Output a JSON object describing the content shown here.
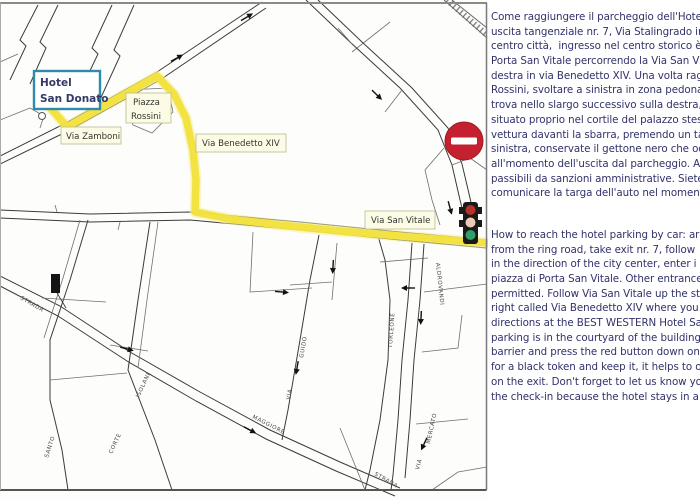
{
  "map": {
    "hotel_label": {
      "line1": "Hotel",
      "line2": "San Donato"
    },
    "boxed_labels": {
      "piazza_rossini_1": "Piazza",
      "piazza_rossini_2": "Rossini",
      "via_zamboni": "Via Zamboni",
      "via_benedetto_xiv": "Via Benedetto XIV",
      "via_san_vitale": "Via San Vitale"
    },
    "street_labels": [
      {
        "text": "STRADA"
      },
      {
        "text": "MAGGIORE"
      },
      {
        "text": "STRADA"
      },
      {
        "text": "SANTO"
      },
      {
        "text": "CORTE"
      },
      {
        "text": "ISOLANI"
      },
      {
        "text": "GUIDO"
      },
      {
        "text": "VIA"
      },
      {
        "text": "TORLEONE"
      },
      {
        "text": "ALDROVANDI"
      },
      {
        "text": "MERCATO"
      },
      {
        "text": "VIA"
      }
    ],
    "icons": {
      "no_entry": "no-entry-sign",
      "traffic_light": "traffic-light",
      "hotel_marker": "hotel-location-dot",
      "building": "building-marker"
    },
    "colors": {
      "route_yellow": "#f2e13b",
      "route_glow": "#f7ef9a",
      "hotel_box_border": "#2e8bac",
      "no_entry_red": "#c5202f",
      "traffic_red": "#b5332b",
      "traffic_mid": "#e9cbb8",
      "traffic_green": "#2fa06a",
      "street_line": "#3b3b3b",
      "label_box_bg": "#fcfce6",
      "text_navy": "#32326b"
    }
  },
  "directions": {
    "italian": {
      "lines": [
        "Come raggiungere il parcheggio dell'Hotel",
        "uscita tangenziale nr. 7, Via Stalingrado in",
        "centro città,  ingresso nel centro storico è",
        "Porta San Vitale percorrendo la Via San Vit",
        "destra in via Benedetto XIV. Una volta rag",
        "Rossini, svoltare a sinistra in zona pedona",
        "trova nello slargo successivo sulla destra,",
        "situato proprio nel cortile del palazzo stes",
        "vettura davanti la sbarra, premendo un ta",
        "sinistra, conservate il gettone nero che oc",
        "all'momento dell'uscita dal parcheggio. Alt",
        "passibili da sanzioni amministrative. Siete",
        "comunicare la targa dell'auto nel momento"
      ]
    },
    "english": {
      "lines": [
        "How to reach the hotel parking by car: arr",
        "from the ring road, take exit nr. 7, follow",
        "in the direction of the city center, enter i",
        "piazza di Porta San Vitale. Other entrance",
        "permitted. Follow Via San Vitale up the str",
        "right called Via Benedetto XIV where you w",
        "directions at the BEST WESTERN Hotel Sa",
        "parking is in the courtyard of the building.",
        "barrier and press the red button down on t",
        "for a black token and keep it, it helps to o",
        "on the exit. Don't forget to let us know yo",
        "the check-in because the hotel stays in a p"
      ]
    }
  }
}
